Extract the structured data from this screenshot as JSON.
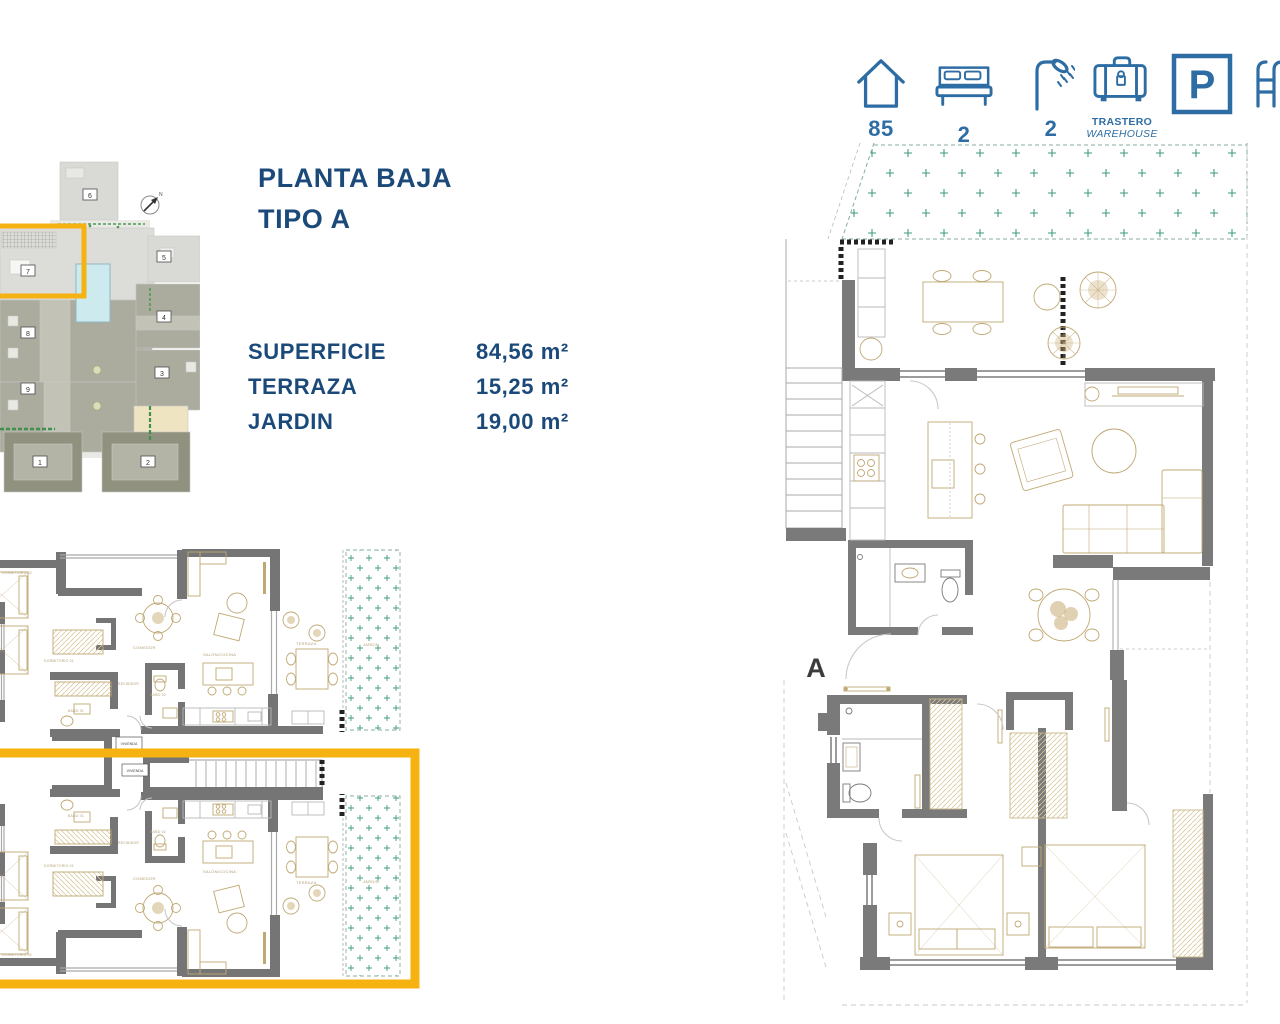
{
  "header": {
    "features": [
      {
        "name": "surface",
        "icon": "house-icon",
        "value": "85"
      },
      {
        "name": "bedrooms",
        "icon": "bed-icon",
        "value": "2"
      },
      {
        "name": "bathrooms",
        "icon": "shower-icon",
        "value": "2"
      },
      {
        "name": "storage",
        "icon": "warehouse-icon",
        "label_es": "TRASTERO",
        "label_en": "WAREHOUSE"
      },
      {
        "name": "parking",
        "icon": "parking-icon",
        "letter": "P"
      },
      {
        "name": "pool",
        "icon": "pool-icon"
      }
    ]
  },
  "title": {
    "line1": "PLANTA BAJA",
    "line2": "TIPO A"
  },
  "areas": {
    "rows": [
      {
        "label": "SUPERFICIE",
        "value": "84,56 m²"
      },
      {
        "label": "TERRAZA",
        "value": "15,25 m²"
      },
      {
        "label": "JARDIN",
        "value": "19,00 m²"
      }
    ]
  },
  "site_plan": {
    "compass": "N",
    "highlighted_unit": "7",
    "units": [
      "1",
      "2",
      "3",
      "4",
      "5",
      "6",
      "7",
      "8",
      "9"
    ]
  },
  "floor_plan": {
    "block_label": "A",
    "unit_tag": "VIVIENDA",
    "rooms": {
      "dormitorio_01": "DORMITORIO 01",
      "dormitorio_02": "DORMITORIO 02",
      "bano_01": "BAÑO 01",
      "bano_02": "BAÑO 02",
      "recibidor": "RECIBIDOR",
      "comedor": "COMEDOR",
      "salon_cocina": "SALÓN/COCINA",
      "terraza": "TERRAZA",
      "jardin": "JARDIN"
    }
  },
  "colors": {
    "navy": "#1b4a7a",
    "icon_blue": "#2e6da4",
    "accent_yellow": "#f6b211",
    "wall_gray": "#7a7a7a",
    "furniture_tan": "#bfa873",
    "garden_green": "#3f9e78"
  }
}
